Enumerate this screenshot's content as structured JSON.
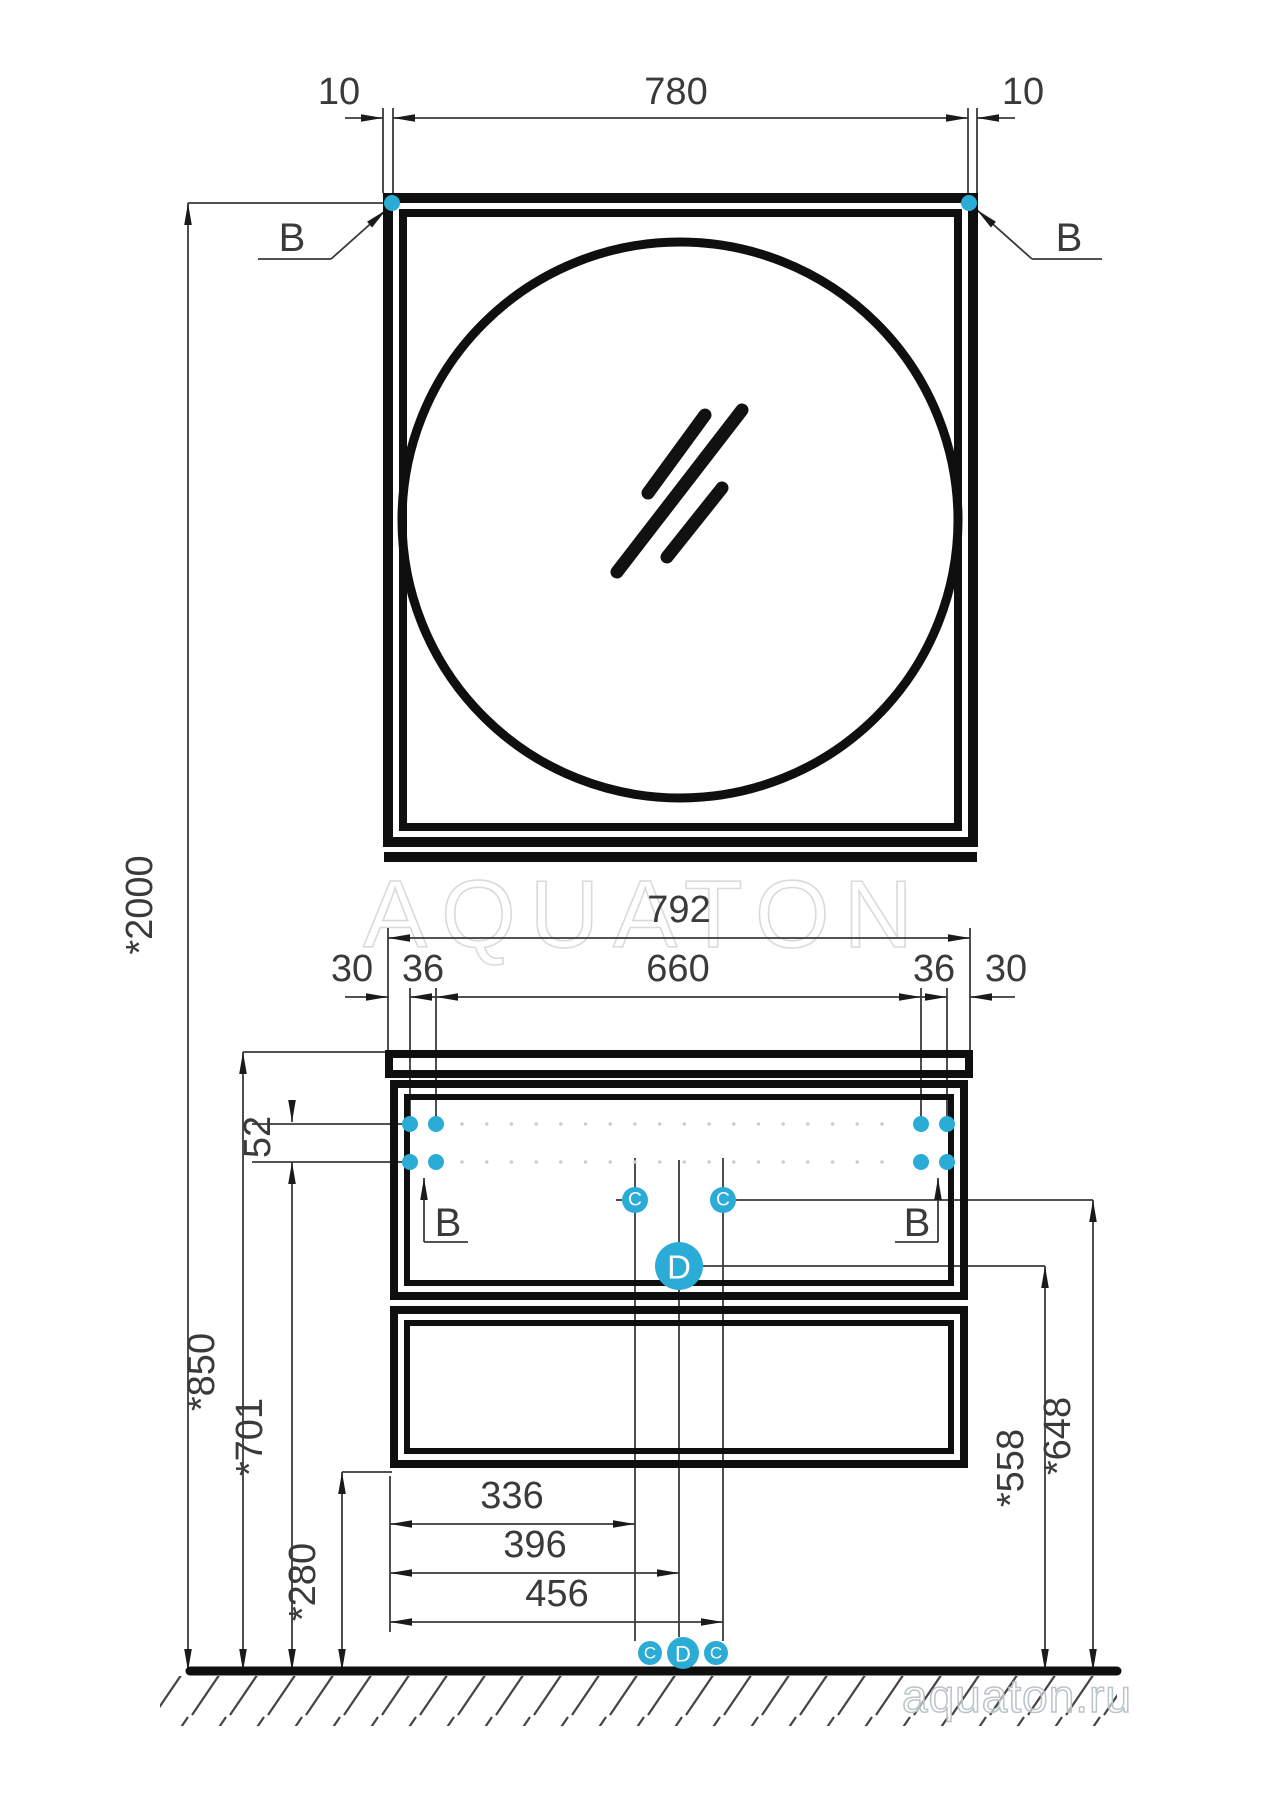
{
  "watermark": {
    "center": "AQUATON",
    "corner": "aquaton.ru"
  },
  "colors": {
    "accent": "#2AACD6",
    "line": "#0f0f0f",
    "dim": "#3a3a3a"
  },
  "mirror_view": {
    "offset_left": "10",
    "width": "780",
    "offset_right": "10",
    "callout_b": "B"
  },
  "cabinet_view": {
    "overall_width": "792",
    "edge_left": "30",
    "hole_inset_left": "36",
    "hole_span": "660",
    "hole_inset_right": "36",
    "edge_right": "30",
    "hole_row_spacing": "52",
    "callout_b": "B",
    "callout_c": "C",
    "callout_d": "D",
    "drain_dims": {
      "c_left": "336",
      "d_center": "396",
      "c_right": "456"
    }
  },
  "heights": {
    "overall": "*2000",
    "worktop": "*850",
    "holes": "*701",
    "cabinet_bottom": "*280",
    "d_callout": "*558",
    "c_callout": "*648"
  }
}
